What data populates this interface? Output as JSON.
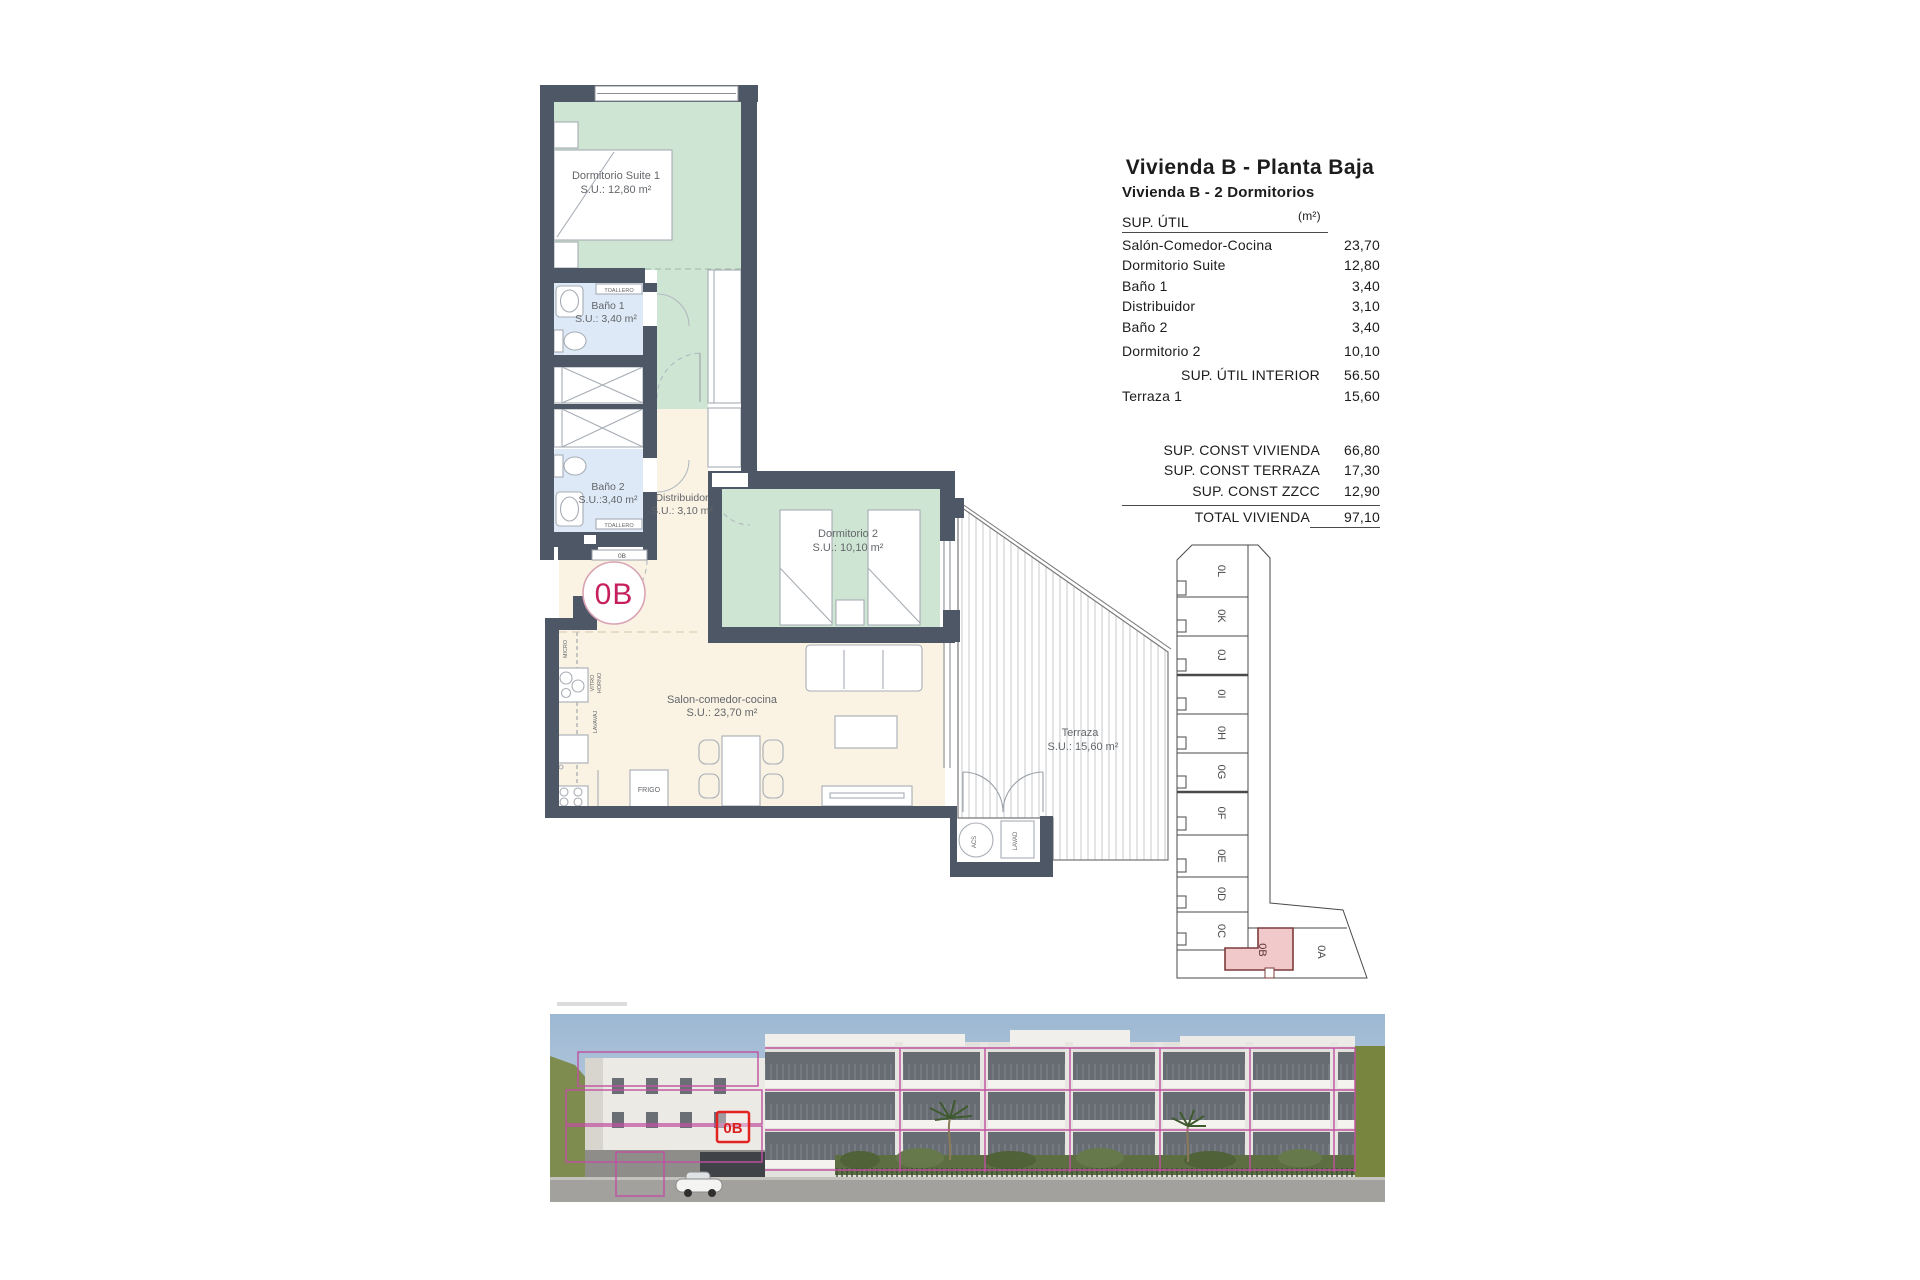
{
  "header": {
    "title": "Vivienda B - Planta Baja",
    "subtitle": "Vivienda B - 2 Dormitorios"
  },
  "area_table": {
    "col_label": "SUP. ÚTIL",
    "col_unit": "(m²)",
    "rows": [
      {
        "label": "Salón-Comedor-Cocina",
        "value": "23,70"
      },
      {
        "label": "Dormitorio Suite",
        "value": "12,80"
      },
      {
        "label": "Baño 1",
        "value": "3,40"
      },
      {
        "label": "Distribuidor",
        "value": "3,10"
      },
      {
        "label": "Baño 2",
        "value": "3,40"
      },
      {
        "label": "Dormitorio 2",
        "value": "10,10"
      }
    ],
    "interior_total": {
      "label": "SUP. ÚTIL INTERIOR",
      "value": "56.50"
    },
    "terrace_row": {
      "label": "Terraza 1",
      "value": "15,60"
    },
    "const_rows": [
      {
        "label": "SUP. CONST VIVIENDA",
        "value": "66,80"
      },
      {
        "label": "SUP. CONST TERRAZA",
        "value": "17,30"
      },
      {
        "label": "SUP. CONST ZZCC",
        "value": "12,90"
      }
    ],
    "total": {
      "label": "TOTAL VIVIENDA",
      "value": "97,10"
    }
  },
  "plan": {
    "unit_badge": "0B",
    "entry_tag": "0B",
    "rooms": {
      "suite_name": "Dormitorio Suite 1",
      "suite_area": "S.U.: 12,80 m²",
      "bano1_name": "Baño 1",
      "bano1_area": "S.U.: 3,40 m²",
      "bano2_name": "Baño 2",
      "bano2_area": "S.U.:3,40 m²",
      "distribuidor_name": "Distribuidor",
      "distribuidor_area": "S.U.: 3,10 m²",
      "dorm2_name": "Dormitorio 2",
      "dorm2_area": "S.U.: 10,10 m²",
      "salon_name": "Salon-comedor-cocina",
      "salon_area": "S.U.: 23,70 m²",
      "terraza_name": "Terraza",
      "terraza_area": "S.U.: 15,60 m²"
    },
    "fixtures": {
      "toallero": "TOALLERO",
      "frigo": "FRIGO",
      "micro": "MICRO",
      "vitro": "VITRO",
      "horno": "HORNO",
      "lavavaj": "LAVAVAJ",
      "acs": "ACS",
      "lavad": "LAVAD"
    }
  },
  "keyplan": {
    "units": [
      "0L",
      "0K",
      "0J",
      "0I",
      "0H",
      "0G",
      "0F",
      "0E",
      "0D",
      "0C"
    ],
    "highlight_label": "0B",
    "neighbor_label": "0A"
  },
  "render": {
    "badge": "0B"
  },
  "colors": {
    "wall": "#4e5766",
    "room_green": "#cfe5d3",
    "room_blue": "#dde9f6",
    "room_cream": "#faf3e4",
    "unit_badge_text": "#c51f5d",
    "keyplan_highlight_fill": "#f2c9cb",
    "keyplan_highlight_border": "#7c3b3b",
    "render_overlay_magenta": "#c050a0",
    "render_badge_red": "#e32222"
  }
}
